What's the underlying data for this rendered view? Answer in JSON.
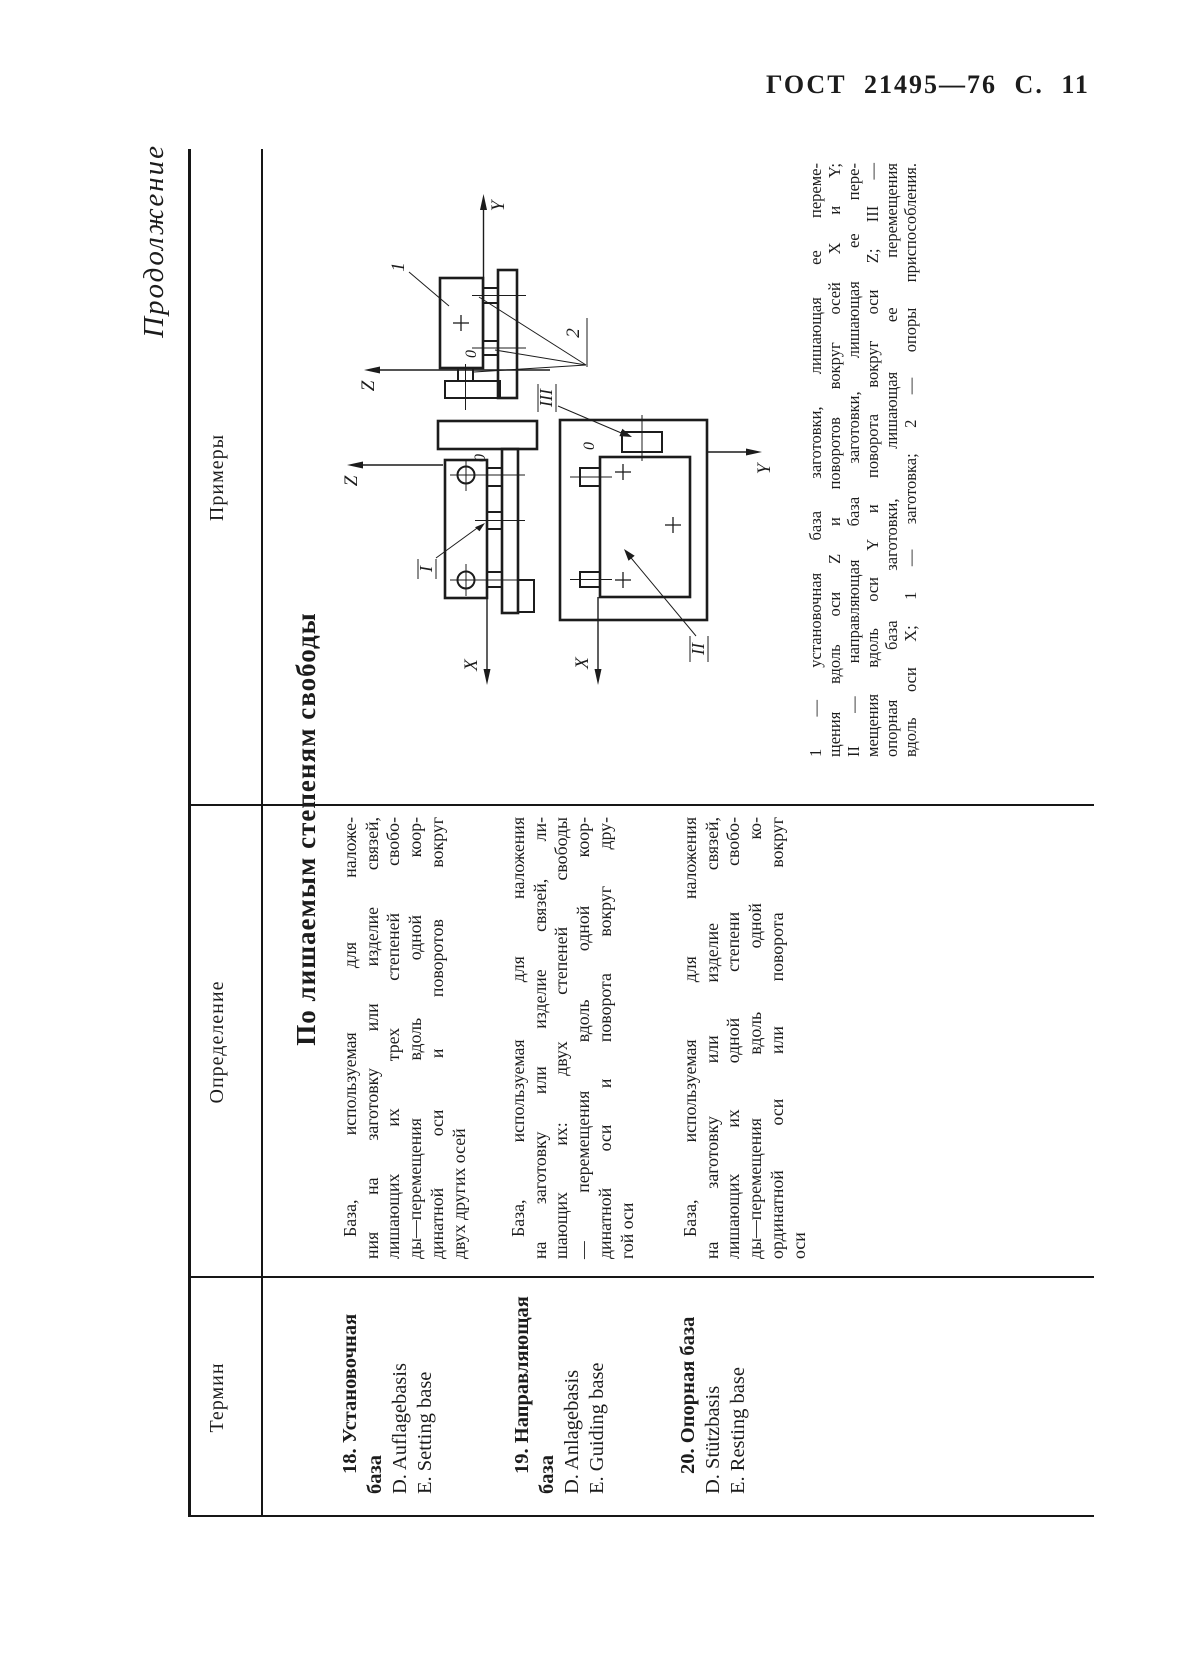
{
  "page_header": {
    "text": "ГОСТ 21495—76 С. 11"
  },
  "continuation": "Продолжение",
  "table": {
    "columns": [
      "Термин",
      "Определение",
      "Примеры"
    ],
    "section_heading": "По лишаемым степеням свободы",
    "rows": [
      {
        "num": "18",
        "term_title_lines": [
          "18. Установочная",
          "база"
        ],
        "term_lang_lines": [
          "D. Auflagebasis",
          "E. Setting base"
        ],
        "definition_lines": [
          "База, используемая для наложе-",
          "ния на заготовку или изделие связей,",
          "лишающих их трех степеней свобо-",
          "ды—перемещения вдоль одной коор-",
          "динатной оси и поворотов вокруг",
          "двух других осей"
        ]
      },
      {
        "num": "19",
        "term_title_lines": [
          "19. Направляющая",
          "база"
        ],
        "term_lang_lines": [
          "D. Anlagebasis",
          "E. Guiding base"
        ],
        "definition_lines": [
          "База, используемая для наложения",
          "на заготовку или изделие связей, ли-",
          "шающих их: двух степеней свободы",
          "— перемещения вдоль одной коор-",
          "динатной оси и поворота вокруг дру-",
          "гой оси"
        ]
      },
      {
        "num": "20",
        "term_title_lines": [
          "20. Опорная база"
        ],
        "term_lang_lines": [
          "D. Stützbasis",
          "E. Resting base"
        ],
        "definition_lines": [
          "База, используемая для наложения",
          "на заготовку или изделие связей,",
          "лишающих их одной степени свобо-",
          "ды—перемещения вдоль одной ко-",
          "ординатной оси или поворота вокруг",
          "оси"
        ]
      }
    ]
  },
  "figure": {
    "caption_lines": [
      "1 — установочная база заготовки, лишающая ее переме-",
      "щения вдоль оси Z и поворотов вокруг осей X и Y;",
      "II — направляющая база заготовки, лишающая ее пере-",
      "мещения вдоль оси Y и поворота вокруг оси Z; III —",
      "опорная база заготовки, лишающая ее перемещения",
      "вдоль оси X; 1 — заготовка; 2 — опоры приспособления."
    ],
    "labels": {
      "axis_x": "X",
      "axis_y": "Y",
      "axis_z": "Z",
      "origin": "0",
      "workpiece": "1",
      "supports": "2",
      "base_i": "I",
      "base_ii": "II",
      "base_iii": "III"
    }
  }
}
